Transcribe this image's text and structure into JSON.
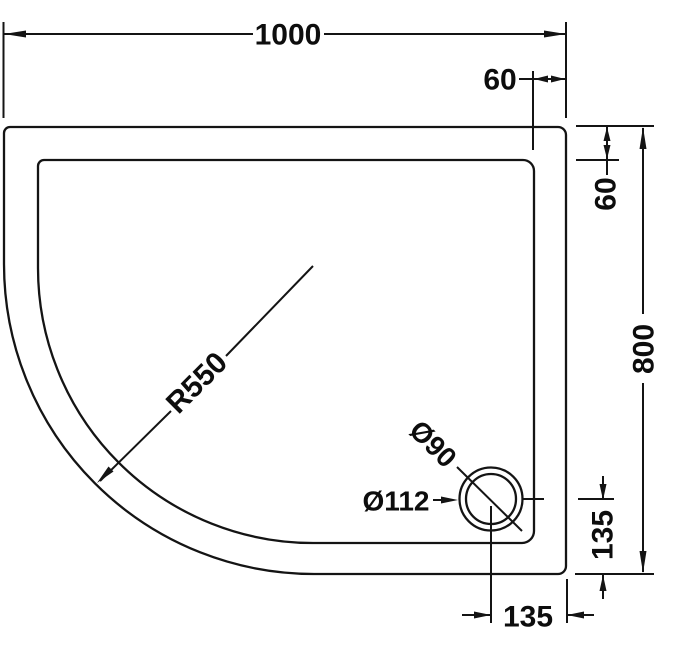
{
  "page": {
    "background": "#ffffff"
  },
  "drawing": {
    "type": "technical dimension drawing",
    "subject": "offset quadrant shower tray, plan view with waste hole",
    "line_color": "#141414",
    "text_color": "#0d0d0d",
    "dimensions": {
      "overall_width": "1000",
      "overall_depth": "800",
      "rim_inset_top": "60",
      "rim_inset_right": "60",
      "corner_radius": "R550",
      "waste_outer_diameter": "Ø112",
      "waste_inner_diameter": "Ø90",
      "waste_offset_bottom": "135",
      "waste_offset_right": "135"
    }
  }
}
